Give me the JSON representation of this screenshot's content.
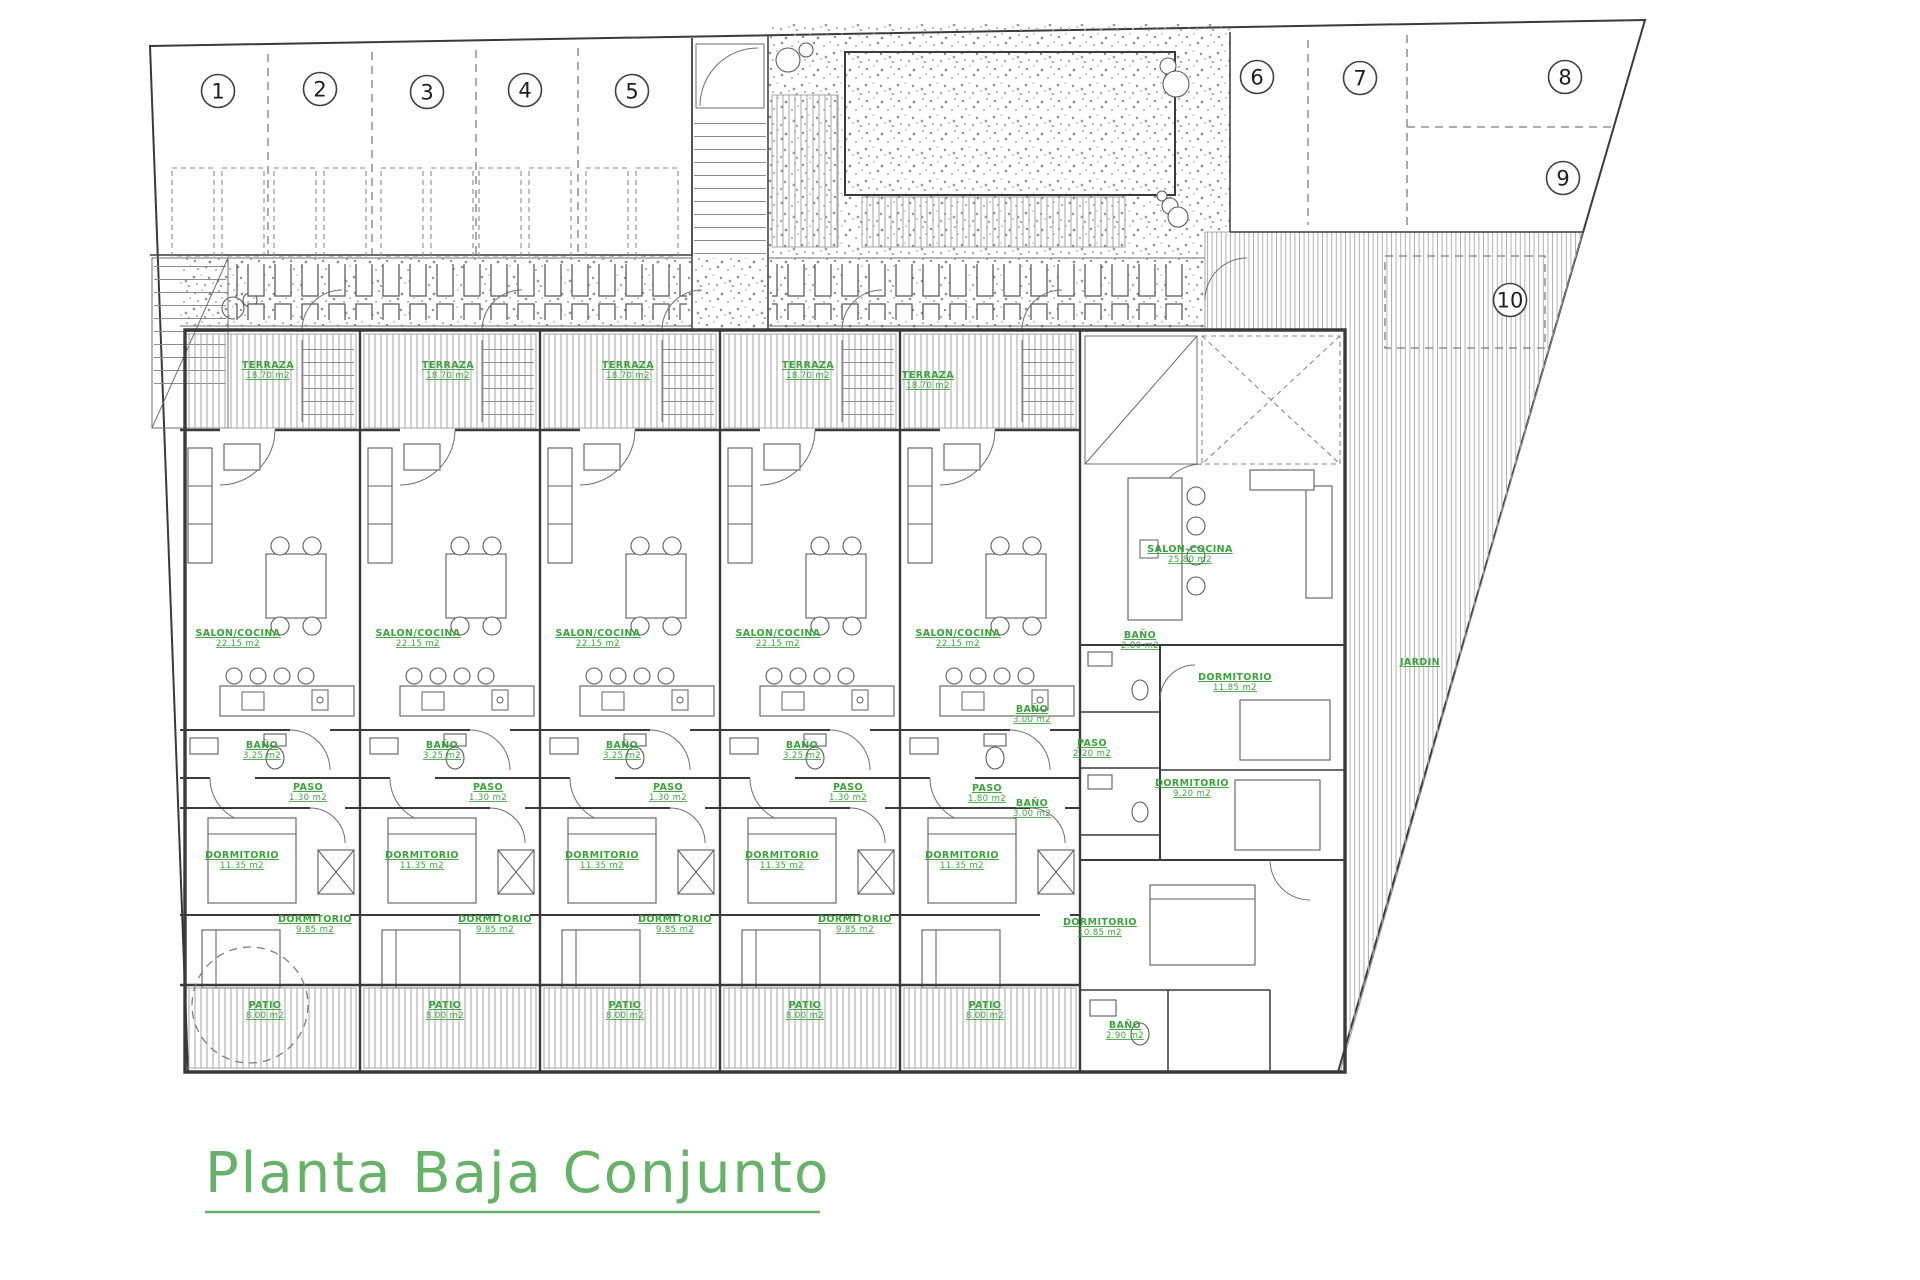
{
  "title": {
    "text": "Planta Baja Conjunto"
  },
  "colors": {
    "label_green": "#3da23d",
    "title_green": "#68b168",
    "wall": "#3a3a3a",
    "hatch": "#a6a6a6",
    "background": "#ffffff"
  },
  "parking_badges": [
    {
      "n": "1",
      "x": 218,
      "y": 91
    },
    {
      "n": "2",
      "x": 320,
      "y": 89
    },
    {
      "n": "3",
      "x": 427,
      "y": 92
    },
    {
      "n": "4",
      "x": 525,
      "y": 90
    },
    {
      "n": "5",
      "x": 632,
      "y": 91
    },
    {
      "n": "6",
      "x": 1257,
      "y": 77
    },
    {
      "n": "7",
      "x": 1360,
      "y": 78
    },
    {
      "n": "8",
      "x": 1565,
      "y": 77
    },
    {
      "n": "9",
      "x": 1563,
      "y": 178
    },
    {
      "n": "10",
      "x": 1510,
      "y": 300
    }
  ],
  "labels": [
    {
      "name": "TERRAZA",
      "area": "18.70 m2",
      "x": 268,
      "y": 368
    },
    {
      "name": "SALON/COCINA",
      "area": "22.15 m2",
      "x": 238,
      "y": 636
    },
    {
      "name": "BAÑO",
      "area": "3.25 m2",
      "x": 262,
      "y": 748
    },
    {
      "name": "PASO",
      "area": "1.30 m2",
      "x": 308,
      "y": 790
    },
    {
      "name": "DORMITORIO",
      "area": "11.35 m2",
      "x": 242,
      "y": 858
    },
    {
      "name": "DORMITORIO",
      "area": "9.85 m2",
      "x": 315,
      "y": 922
    },
    {
      "name": "PATIO",
      "area": "8.00 m2",
      "x": 265,
      "y": 1008
    },
    {
      "name": "TERRAZA",
      "area": "18.70 m2",
      "x": 448,
      "y": 368
    },
    {
      "name": "SALON/COCINA",
      "area": "22.15 m2",
      "x": 418,
      "y": 636
    },
    {
      "name": "BAÑO",
      "area": "3.25 m2",
      "x": 442,
      "y": 748
    },
    {
      "name": "PASO",
      "area": "1.30 m2",
      "x": 488,
      "y": 790
    },
    {
      "name": "DORMITORIO",
      "area": "11.35 m2",
      "x": 422,
      "y": 858
    },
    {
      "name": "DORMITORIO",
      "area": "9.85 m2",
      "x": 495,
      "y": 922
    },
    {
      "name": "PATIO",
      "area": "8.00 m2",
      "x": 445,
      "y": 1008
    },
    {
      "name": "TERRAZA",
      "area": "18.70 m2",
      "x": 628,
      "y": 368
    },
    {
      "name": "SALON/COCINA",
      "area": "22.15 m2",
      "x": 598,
      "y": 636
    },
    {
      "name": "BAÑO",
      "area": "3.25 m2",
      "x": 622,
      "y": 748
    },
    {
      "name": "PASO",
      "area": "1.30 m2",
      "x": 668,
      "y": 790
    },
    {
      "name": "DORMITORIO",
      "area": "11.35 m2",
      "x": 602,
      "y": 858
    },
    {
      "name": "DORMITORIO",
      "area": "9.85 m2",
      "x": 675,
      "y": 922
    },
    {
      "name": "PATIO",
      "area": "8.00 m2",
      "x": 625,
      "y": 1008
    },
    {
      "name": "TERRAZA",
      "area": "18.70 m2",
      "x": 808,
      "y": 368
    },
    {
      "name": "SALON/COCINA",
      "area": "22.15 m2",
      "x": 778,
      "y": 636
    },
    {
      "name": "BAÑO",
      "area": "3.25 m2",
      "x": 802,
      "y": 748
    },
    {
      "name": "PASO",
      "area": "1.30 m2",
      "x": 848,
      "y": 790
    },
    {
      "name": "DORMITORIO",
      "area": "11.35 m2",
      "x": 782,
      "y": 858
    },
    {
      "name": "DORMITORIO",
      "area": "9.85 m2",
      "x": 855,
      "y": 922
    },
    {
      "name": "PATIO",
      "area": "8.00 m2",
      "x": 805,
      "y": 1008
    },
    {
      "name": "TERRAZA",
      "area": "18.70 m2",
      "x": 928,
      "y": 378
    },
    {
      "name": "SALON/COCINA",
      "area": "22.15 m2",
      "x": 958,
      "y": 636
    },
    {
      "name": "BAÑO",
      "area": "3.00 m2",
      "x": 1032,
      "y": 712
    },
    {
      "name": "PASO",
      "area": "1.80 m2",
      "x": 987,
      "y": 791
    },
    {
      "name": "BAÑO",
      "area": "3.00 m2",
      "x": 1032,
      "y": 806
    },
    {
      "name": "DORMITORIO",
      "area": "11.35 m2",
      "x": 962,
      "y": 858
    },
    {
      "name": "PATIO",
      "area": "8.00 m2",
      "x": 985,
      "y": 1008
    },
    {
      "name": "SALON-COCINA",
      "area": "25.80 m2",
      "x": 1190,
      "y": 552
    },
    {
      "name": "DORMITORIO",
      "area": "11.85 m2",
      "x": 1235,
      "y": 680
    },
    {
      "name": "BAÑO",
      "area": "2.80 m2",
      "x": 1140,
      "y": 638
    },
    {
      "name": "PASO",
      "area": "2.20 m2",
      "x": 1092,
      "y": 746
    },
    {
      "name": "DORMITORIO",
      "area": "9.20 m2",
      "x": 1192,
      "y": 786
    },
    {
      "name": "DORMITORIO",
      "area": "10.85 m2",
      "x": 1100,
      "y": 925
    },
    {
      "name": "BAÑO",
      "area": "2.90 m2",
      "x": 1125,
      "y": 1028
    },
    {
      "name": "JARDIN",
      "area": "",
      "x": 1420,
      "y": 665
    }
  ]
}
